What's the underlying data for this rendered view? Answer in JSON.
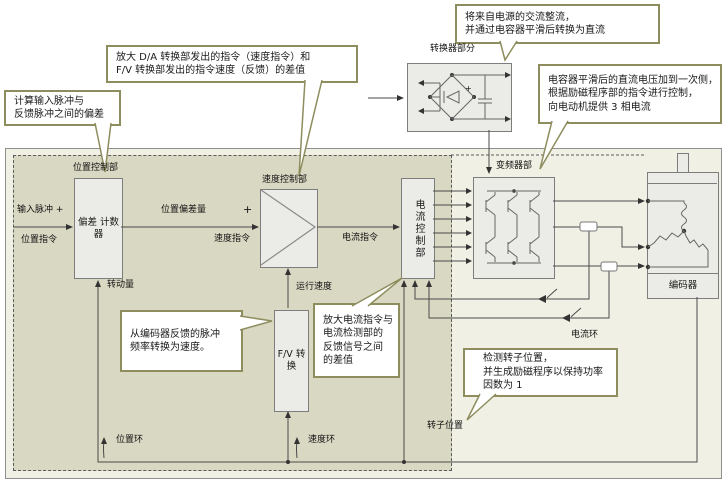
{
  "callouts": {
    "rectifier": {
      "line1": "将来自电源的交流整流，",
      "line2": "并通过电容器平滑后转换为直流"
    },
    "speed_amp": {
      "line1": "放大 D/A 转换部发出的指令（速度指令）和",
      "line2": "F/V 转换部发出的指令速度（反馈）的差值"
    },
    "pulse_dev": {
      "line1": "计算输入脉冲与",
      "line2": "反馈脉冲之间的偏差"
    },
    "dc_voltage": {
      "line1": "电容器平滑后的直流电压加到一次侧，",
      "line2": "根据励磁程序部的指令进行控制，",
      "line3": "向电动机提供 3 相电流"
    },
    "fv_convert": {
      "line1": "从编码器反馈的脉冲",
      "line2": "频率转换为速度。"
    },
    "current_amp": {
      "line1": "放大电流指令与",
      "line2": "电流检测部的",
      "line3": "反馈信号之间",
      "line4": "的差值"
    },
    "rotor_detect": {
      "line1": "检测转子位置，",
      "line2": "并生成励磁程序以保持功率",
      "line3": "因数为 1"
    }
  },
  "blocks": {
    "converter_label": "转换器部分",
    "position_control_label": "位置控制部",
    "deviation_counter": {
      "line1": "偏差",
      "line2": "计数器"
    },
    "speed_control_label": "速度控制部",
    "current_control_label": "电流控制部",
    "fv_block": {
      "line1": "F/V",
      "line2": "转换"
    },
    "inverter_label": "变频器部",
    "encoder_label": "编码器"
  },
  "wire_labels": {
    "input_pulse": "输入脉冲 +",
    "position_cmd": "位置指令",
    "position_deviation": "位置偏差量",
    "plus_sign": "+",
    "speed_cmd": "速度指令",
    "current_cmd": "电流指令",
    "run_speed": "运行速度",
    "rotation_amount": "转动量",
    "position_loop": "位置环",
    "speed_loop": "速度环",
    "current_loop": "电流环",
    "rotor_position": "转子位置",
    "capacitor_plus": "+"
  },
  "colors": {
    "callout_border": "#8d8d5e",
    "servo_amp_bg": "#d9d8c3",
    "outer_bg": "#f1f0e4",
    "block_bg": "#ebebe7",
    "wire": "#4a4a4a"
  }
}
